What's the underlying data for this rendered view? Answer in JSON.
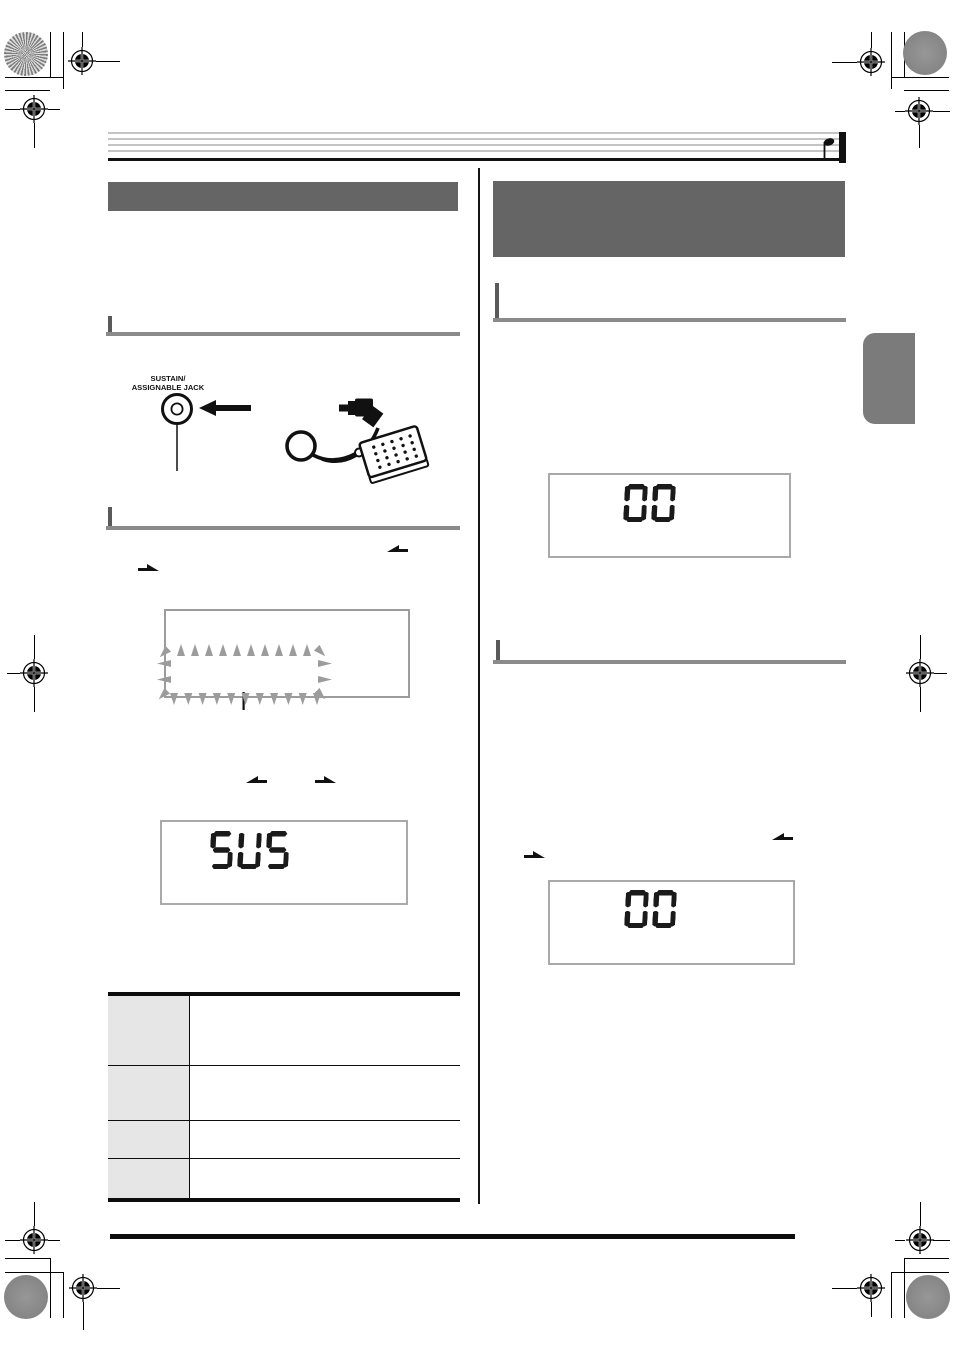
{
  "diagram": {
    "jack_label_line1": "SUSTAIN/",
    "jack_label_line2": "ASSIGNABLE JACK"
  },
  "displays": {
    "pedal_effect": "SUS",
    "value_top": "00",
    "value_bottom": "00"
  },
  "colors": {
    "ink": "#111111",
    "header_bar": "#656565",
    "section_rule": "#8a8a8a",
    "rule_accent": "#5a5a5a",
    "lcd_border": "#a9a9a9",
    "lcd_segment": "#1a1a1a",
    "indicator_gray": "#9c9c9c",
    "table_cell": "#e6e6e6",
    "chapter_tab": "#7b7b7b",
    "staff_line": "#a0a0a0"
  }
}
